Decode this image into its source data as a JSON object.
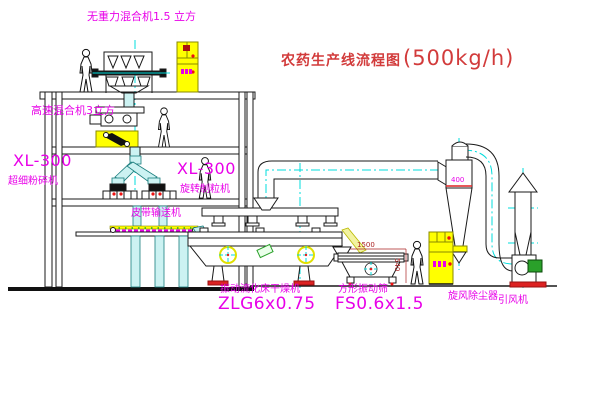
{
  "title": {
    "text": "农药生产线流程图",
    "capacity": "(500kg/h)"
  },
  "equipment_labels": {
    "gravity_mixer": "无重力混合机1.5 立方",
    "high_speed_mixer": "高速混合机3立方",
    "mill_model": "XL-300",
    "mill_name": "超细粉碎机",
    "granulator_model": "XL-300",
    "granulator_name": "旋转制粒机",
    "belt_conveyor": "皮带输送机",
    "dryer_name": "振动流化床干燥机",
    "dryer_model": "ZLG6x0.75",
    "sieve_name": "方形振动筛",
    "sieve_model": "FS0.6x1.5",
    "cyclone_name": "旋风除尘器",
    "fan_name": "引风机"
  },
  "dimensions": {
    "cyclone_diameter": "400",
    "sieve_length": "1500",
    "sieve_height": "540"
  },
  "colors": {
    "label_magenta": "#e800e8",
    "title_red": "#d23b3b",
    "dimension_red": "#aa2222",
    "cad_yellow": "#ffff00",
    "centerline_cyan": "#00dcdc"
  }
}
